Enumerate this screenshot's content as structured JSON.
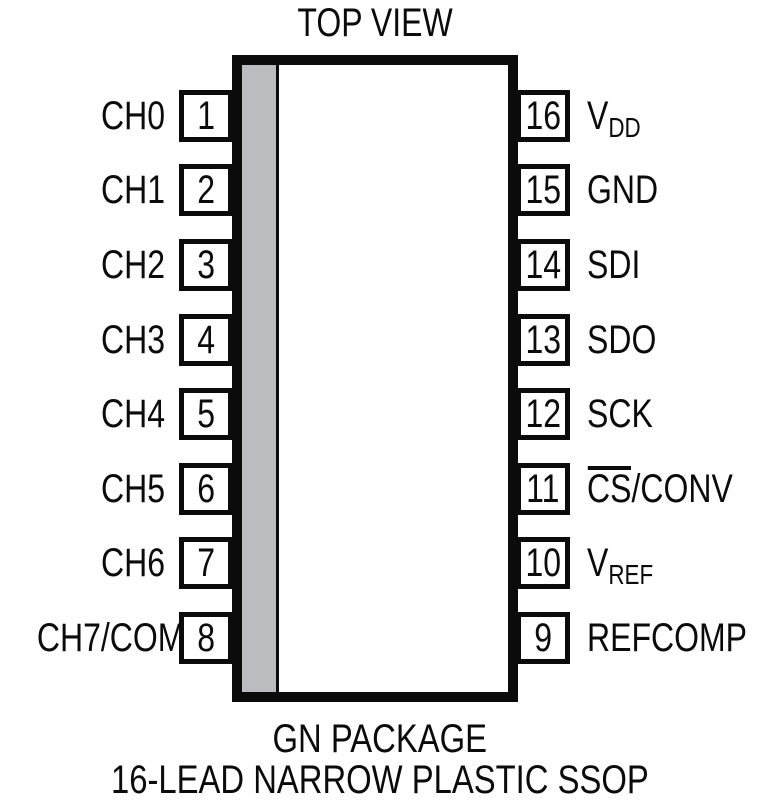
{
  "title": "TOP VIEW",
  "package": {
    "caption_line1": "GN PACKAGE",
    "caption_line2": "16-LEAD NARROW PLASTIC SSOP"
  },
  "colors": {
    "line": "#0b0b0b",
    "stripe": "#bbbcc0"
  },
  "pins": {
    "left": [
      {
        "number": "1",
        "main": "CH0"
      },
      {
        "number": "2",
        "main": "CH1"
      },
      {
        "number": "3",
        "main": "CH2"
      },
      {
        "number": "4",
        "main": "CH3"
      },
      {
        "number": "5",
        "main": "CH4"
      },
      {
        "number": "6",
        "main": "CH5"
      },
      {
        "number": "7",
        "main": "CH6"
      },
      {
        "number": "8",
        "main": "CH7/COM"
      }
    ],
    "right": [
      {
        "number": "16",
        "main": "V",
        "sub": "DD"
      },
      {
        "number": "15",
        "main": "GND"
      },
      {
        "number": "14",
        "main": "SDI"
      },
      {
        "number": "13",
        "main": "SDO"
      },
      {
        "number": "12",
        "main": "SCK"
      },
      {
        "number": "11",
        "over": "CS",
        "main": "/CONV"
      },
      {
        "number": "10",
        "main": "V",
        "sub": "REF"
      },
      {
        "number": "9",
        "main": "REFCOMP"
      }
    ]
  }
}
